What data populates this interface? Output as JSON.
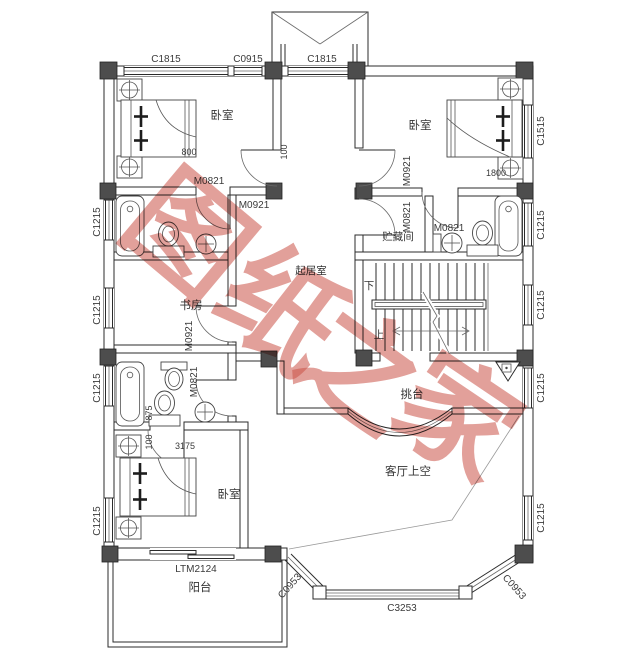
{
  "plan": {
    "watermark": {
      "full_text": "图纸之家",
      "char_0": "图",
      "char_1": "纸",
      "char_2": "之",
      "char_3": "家",
      "color": "#cb5247"
    },
    "rooms": {
      "bedroom_top_left": "卧室",
      "bedroom_top_right": "卧室",
      "bedroom_bottom_left": "卧室",
      "study": "书房",
      "storage_room": "贮藏间",
      "living_room": "起居室",
      "cantilever_platform": "挑台",
      "living_room_void": "客厅上空",
      "balcony": "阳台"
    },
    "stairs": {
      "down_label": "下",
      "up_label": "上"
    },
    "windows": {
      "top_left": "C1815",
      "top_middle": "C0915",
      "top_entry": "C1815",
      "left_1": "C1215",
      "left_2": "C1215",
      "left_3": "C1215",
      "left_4": "C1215",
      "right_1": "C1515",
      "right_2": "C1215",
      "right_3": "C1215",
      "right_4": "C1215",
      "right_5": "C1215",
      "bay_left": "C0953",
      "bay_center": "C3253",
      "bay_right": "C0953"
    },
    "doors": {
      "balcony_door": "LTM2124",
      "bath_top_left": "M0821",
      "bedroom_top_left": "M0921",
      "bedroom_top_right": "M0921",
      "storage": "M0821",
      "bath_right": "M0821",
      "study": "M0921",
      "bath_lower_left": "M0821"
    },
    "dimensions": {
      "bed_top_left": "800",
      "hall_top": "100",
      "bed_top_right": "1800",
      "bath_lower_left_a": "875",
      "bath_lower_left_b": "100",
      "bedroom_bottom_width": "3175"
    }
  }
}
